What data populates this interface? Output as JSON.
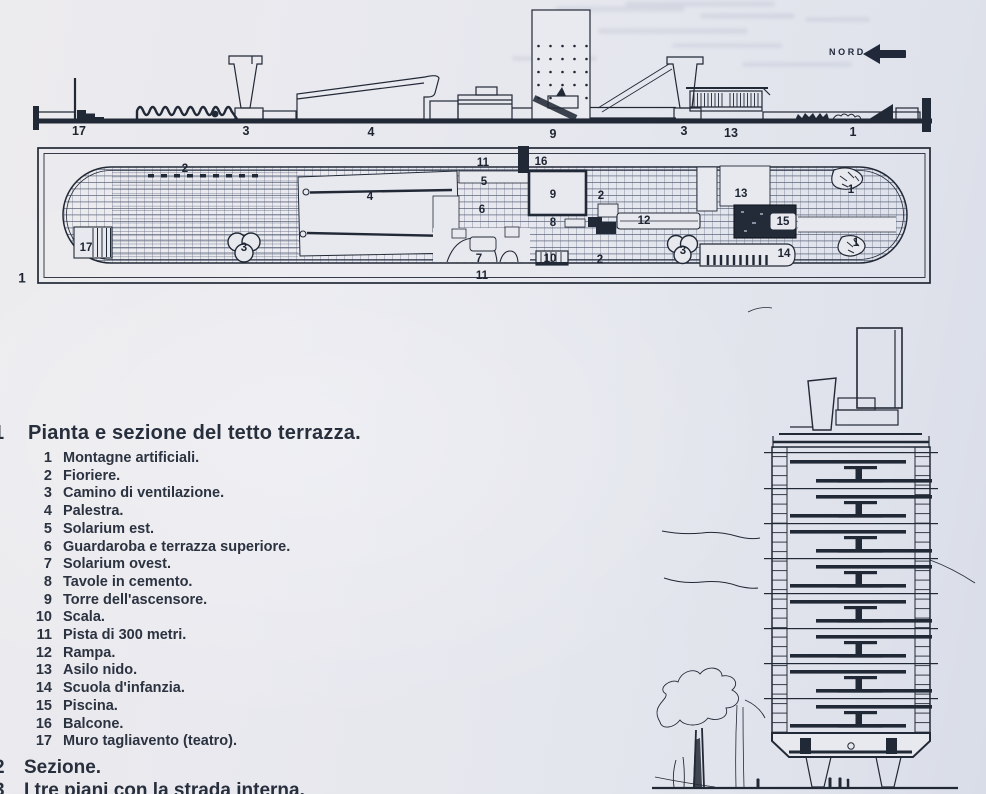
{
  "colors": {
    "paper": "#e7e8ee",
    "ink": "#222936",
    "text": "#2b3240"
  },
  "north": {
    "label": "NORD"
  },
  "section_labels": [
    {
      "t": "17"
    },
    {
      "t": "3"
    },
    {
      "t": "4"
    },
    {
      "t": "9"
    },
    {
      "t": "3"
    },
    {
      "t": "13"
    },
    {
      "t": "1"
    }
  ],
  "plan": {
    "figure_number": "1",
    "labels": [
      {
        "t": "2"
      },
      {
        "t": "17"
      },
      {
        "t": "3"
      },
      {
        "t": "4"
      },
      {
        "t": "11"
      },
      {
        "t": "5"
      },
      {
        "t": "16"
      },
      {
        "t": "6"
      },
      {
        "t": "9"
      },
      {
        "t": "8"
      },
      {
        "t": "7"
      },
      {
        "t": "10"
      },
      {
        "t": "2"
      },
      {
        "t": "2"
      },
      {
        "t": "12"
      },
      {
        "t": "13"
      },
      {
        "t": "15"
      },
      {
        "t": "3"
      },
      {
        "t": "14"
      },
      {
        "t": "1"
      },
      {
        "t": "1"
      },
      {
        "t": "11"
      }
    ]
  },
  "legend": {
    "title_number": "1",
    "title": "Pianta e sezione del tetto terrazza.",
    "items": [
      {
        "n": "1",
        "label": "Montagne artificiali."
      },
      {
        "n": "2",
        "label": "Fioriere."
      },
      {
        "n": "3",
        "label": "Camino di ventilazione."
      },
      {
        "n": "4",
        "label": "Palestra."
      },
      {
        "n": "5",
        "label": "Solarium est."
      },
      {
        "n": "6",
        "label": "Guardaroba e terrazza superiore."
      },
      {
        "n": "7",
        "label": "Solarium ovest."
      },
      {
        "n": "8",
        "label": "Tavole in cemento."
      },
      {
        "n": "9",
        "label": "Torre dell'ascensore."
      },
      {
        "n": "10",
        "label": "Scala."
      },
      {
        "n": "11",
        "label": "Pista di 300 metri."
      },
      {
        "n": "12",
        "label": "Rampa."
      },
      {
        "n": "13",
        "label": "Asilo nido."
      },
      {
        "n": "14",
        "label": "Scuola d'infanzia."
      },
      {
        "n": "15",
        "label": "Piscina."
      },
      {
        "n": "16",
        "label": "Balcone."
      },
      {
        "n": "17",
        "label": "Muro tagliavento (teatro)."
      }
    ],
    "captions": [
      {
        "n": "2",
        "label": "Sezione."
      },
      {
        "n": "3",
        "label": "I tre piani con la strada interna."
      }
    ]
  }
}
